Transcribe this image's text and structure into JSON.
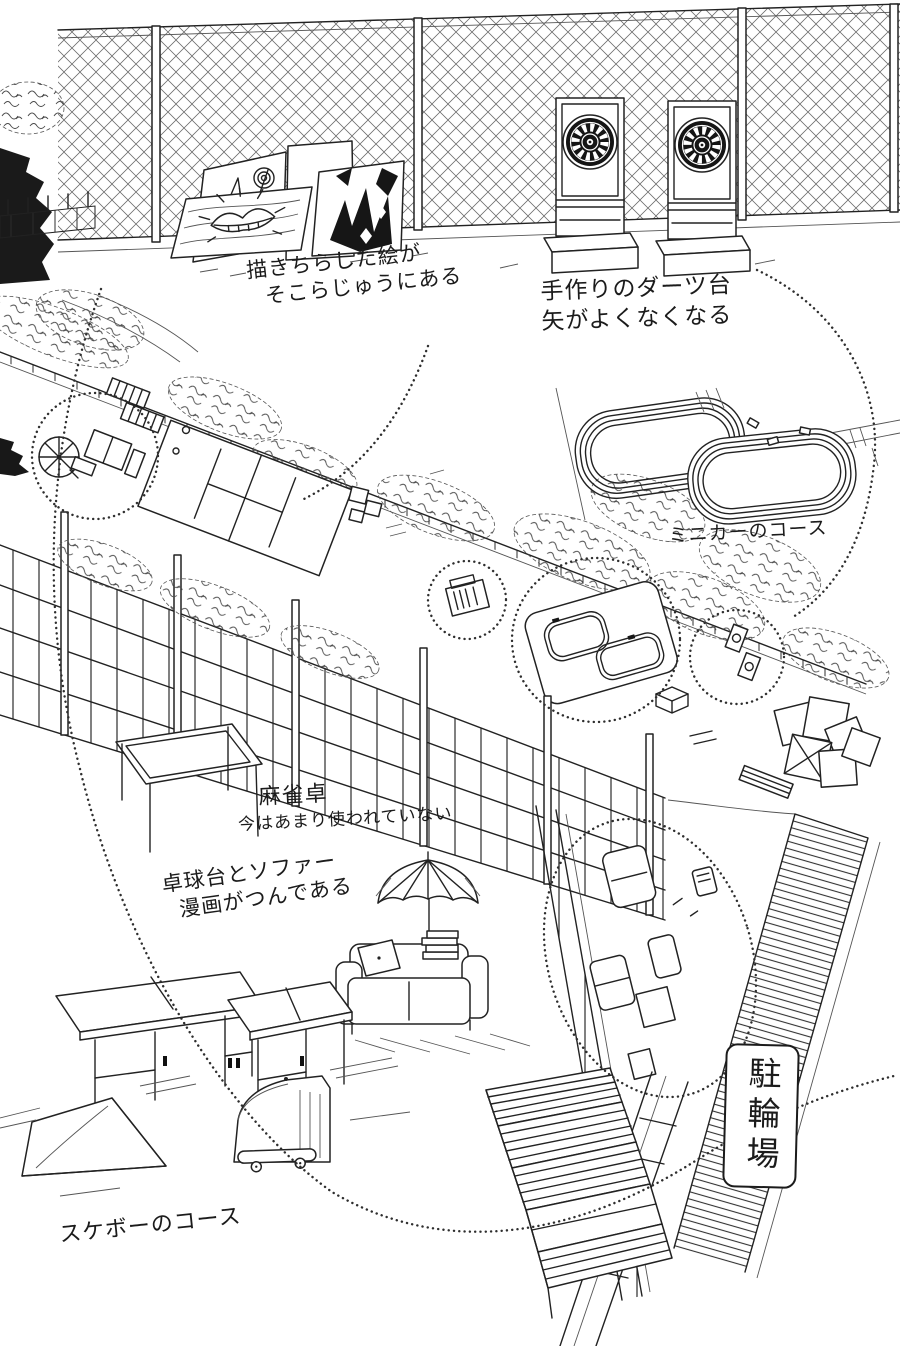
{
  "scene": {
    "type": "manga-setting-illustration",
    "ink_color": "#222222",
    "paper_color": "#ffffff"
  },
  "annotations": {
    "paintings": {
      "line1": "描きちらした絵が",
      "line2": "そこらじゅうにある"
    },
    "darts": {
      "line1": "手作りのダーツ台",
      "line2": "矢がよくなくなる"
    },
    "minicar_course": {
      "line1": "ミニカーのコース"
    },
    "mahjong": {
      "line1": "麻雀卓",
      "line2": "今はあまり使われていない"
    },
    "pingpong_sofa": {
      "line1": "卓球台とソファー",
      "line2": "漫画がつんである"
    },
    "skateboard_course": {
      "line1": "スケボーのコース"
    },
    "bicycle_parking": {
      "label": "駐輪場"
    }
  }
}
